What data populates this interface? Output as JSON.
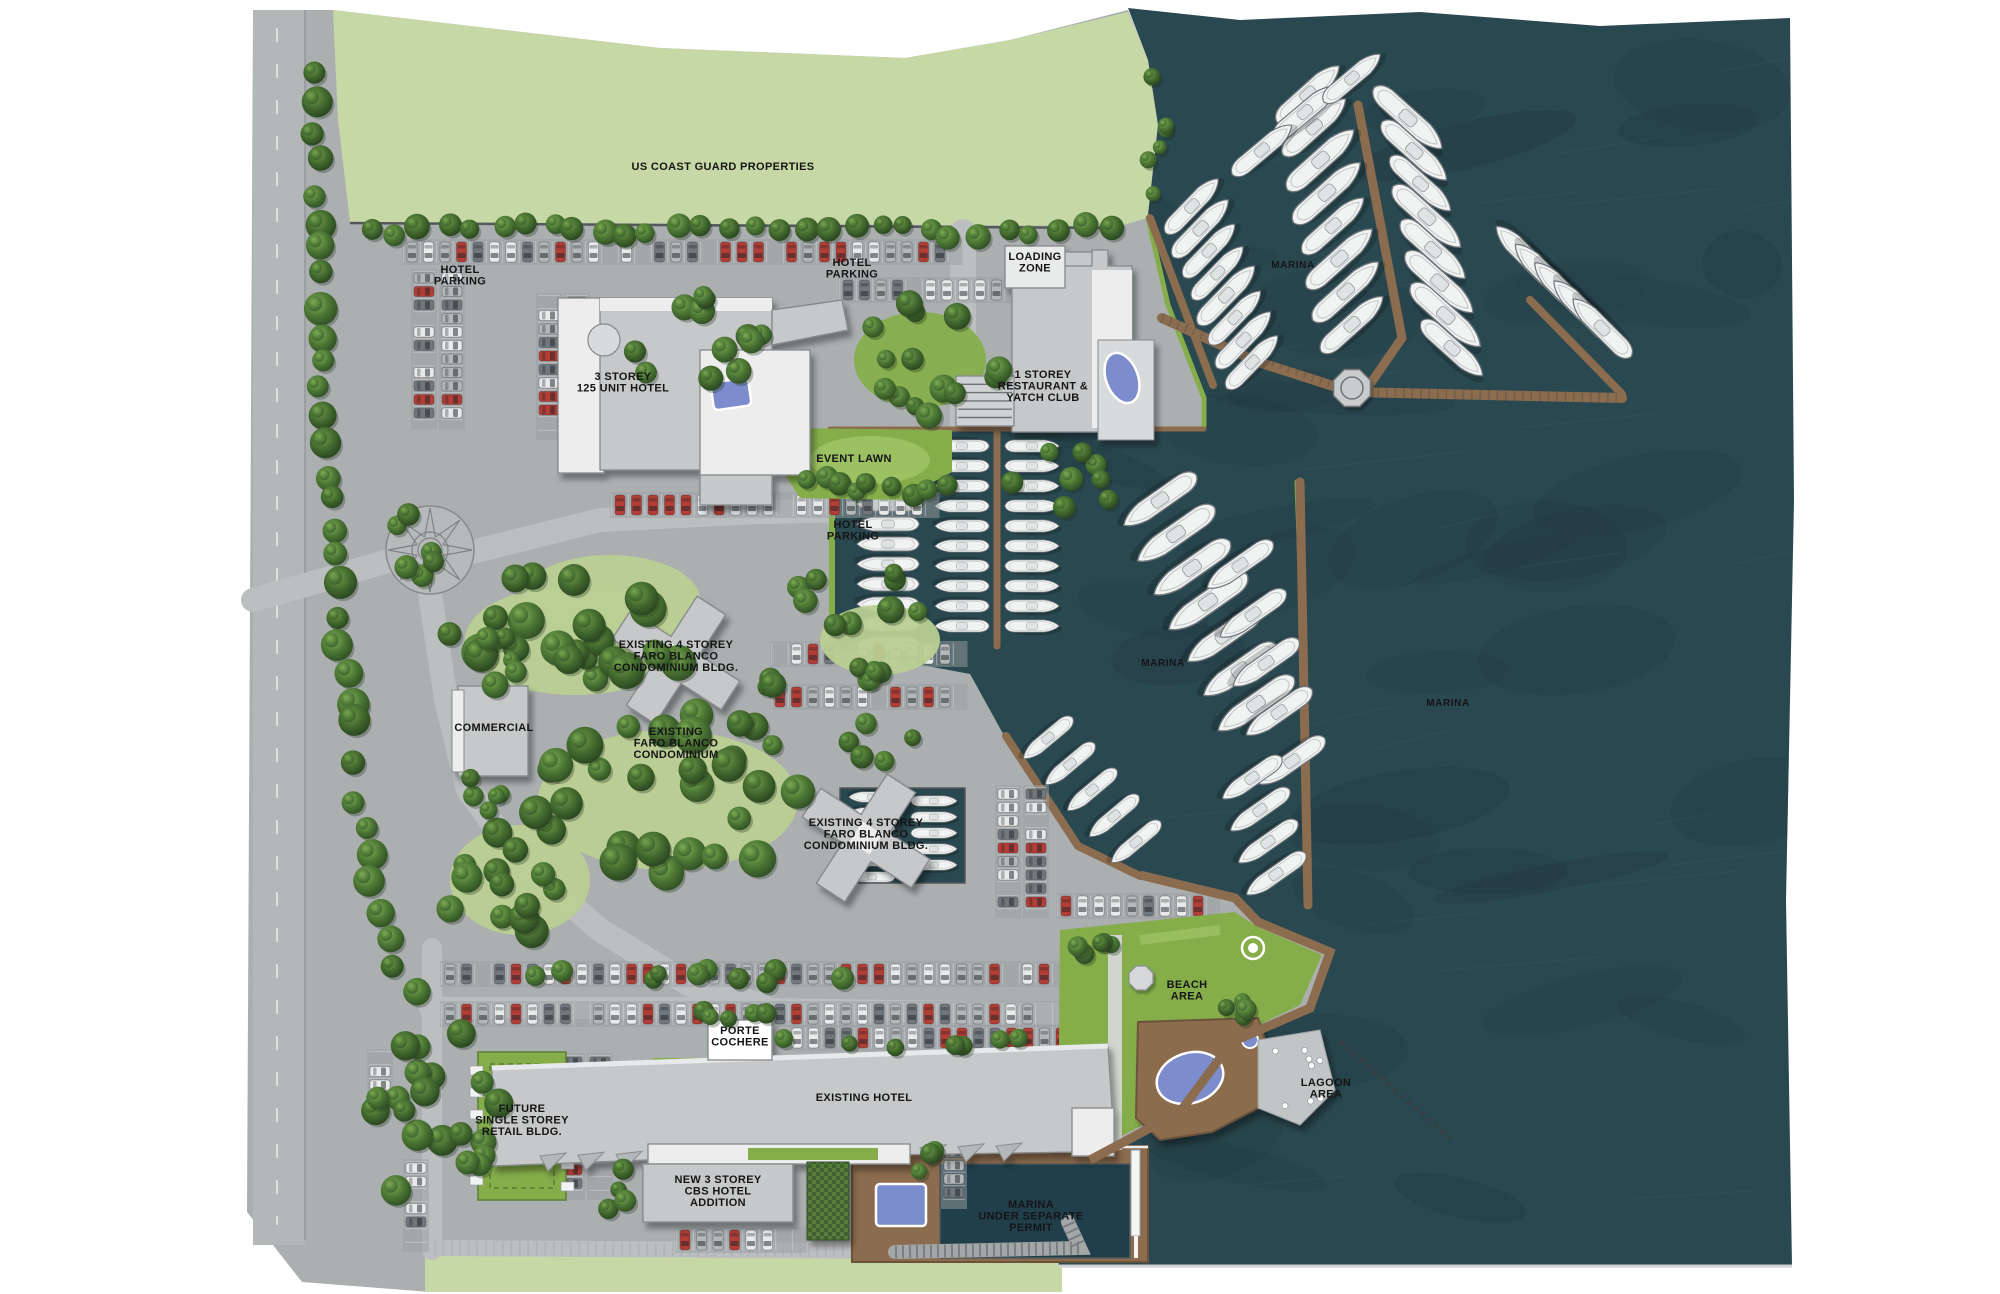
{
  "map": {
    "title": "resort-marina-site-plan",
    "labels": {
      "us_coast_guard": {
        "text": "US COAST GUARD PROPERTIES"
      },
      "hotel_parking_nw": {
        "text": "HOTEL\nPARKING"
      },
      "hotel_parking_n": {
        "text": "HOTEL\nPARKING"
      },
      "hotel_parking_s": {
        "text": "HOTEL\nPARKING"
      },
      "loading_zone": {
        "text": "LOADING\nZONE"
      },
      "hotel_125": {
        "text": "3 STOREY\n125 UNIT HOTEL"
      },
      "restaurant": {
        "text": "1 STOREY\nRESTAURANT &\nYATCH CLUB"
      },
      "event_lawn": {
        "text": "EVENT LAWN"
      },
      "marina_n": {
        "text": "MARINA"
      },
      "marina_w": {
        "text": "MARINA"
      },
      "marina_e": {
        "text": "MARINA"
      },
      "condo_bldg_n": {
        "text": "EXISTING 4 STOREY\nFARO BLANCO\nCONDOMINIUM BLDG."
      },
      "commercial": {
        "text": "COMMERCIAL"
      },
      "condo_existing": {
        "text": "EXISTING\nFARO BLANCO\nCONDOMINIUM"
      },
      "condo_bldg_s": {
        "text": "EXISTING 4 STOREY\nFARO BLANCO\nCONDOMINIUM BLDG."
      },
      "beach_area": {
        "text": "BEACH\nAREA"
      },
      "porte_cochere": {
        "text": "PORTE\nCOCHERE"
      },
      "existing_hotel": {
        "text": "EXISTING HOTEL"
      },
      "future_retail": {
        "text": "FUTURE\nSINGLE STOREY\nRETAIL BLDG."
      },
      "cbs_addition": {
        "text": "NEW 3 STOREY\nCBS HOTEL\nADDITION"
      },
      "marina_permit": {
        "text": "MARINA\nUNDER SEPARATE\nPERMIT"
      },
      "lagoon_area": {
        "text": "LAGOON\nAREA"
      }
    },
    "colors": {
      "land": "#abafb0",
      "road": "#bcbfc0",
      "aisle": "#9b9fa1",
      "concrete": "#d8dadb",
      "field": "#c7d8a7",
      "lawn": "#85ae4b",
      "lawn_light": "#9cc264",
      "woods_lawn": "#b9cf92",
      "water": "#2a4850",
      "water_dark": "#20363e",
      "water_light": "#3f6169",
      "dock": "#8b6c4e",
      "dock_dark": "#6c523a",
      "boat": "#f1f3f3",
      "boat_stroke": "#70767a",
      "building": "#c6c8c9",
      "building_stroke": "#85898b",
      "roof": "#ededee",
      "pool": "#7b8ccc",
      "tree_dark": "#2f4d26",
      "tree_mid": "#4a7334",
      "tree_light": "#7aa24e",
      "car_red": "#b23e36",
      "car_white": "#e9ebeb",
      "car_silver": "#b3b8ba",
      "car_gray": "#71787d",
      "seawall": "#54585a",
      "breakwater": "#a3a7a8",
      "label": "#151515"
    }
  }
}
